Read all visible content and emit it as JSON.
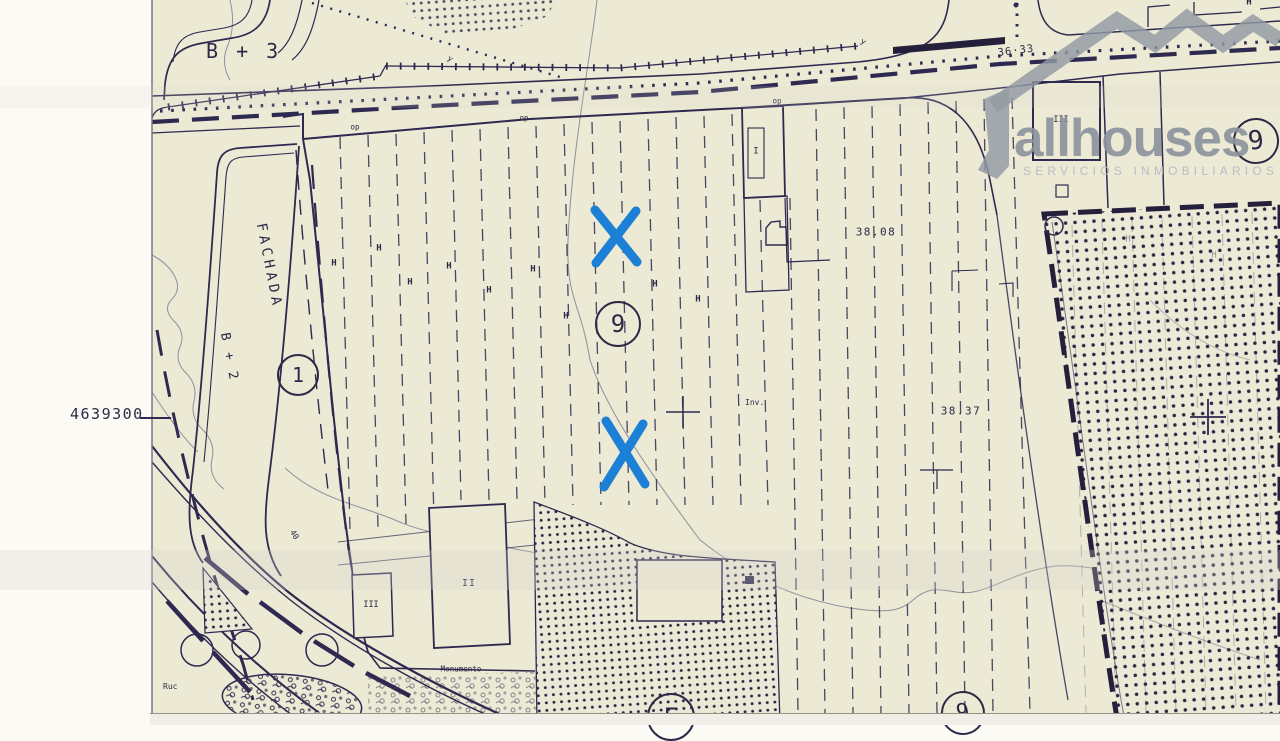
{
  "watermark": {
    "brand": "allhouses",
    "tagline": "SERVICIOS INMOBILIARIOS"
  },
  "map_labels": {
    "coordinate": "4639300",
    "block_top": "B + 3",
    "fachada": "FACHADA",
    "block_left": "B + 2",
    "circle_1": "1",
    "circle_9": "9",
    "circle_e": "E",
    "h_mark": "H",
    "op_mark": "op",
    "y_mark": "y",
    "inv": "Inv.",
    "elev_38_08": "38.08",
    "elev_38_37": "38.37",
    "elev_36_33": "36·33",
    "monumento": "Monumento",
    "ruc": "Ruc",
    "roman_1": "I",
    "roman_2": "II",
    "roman_3": "III",
    "slope_40": "40"
  },
  "annotations": {
    "marker_shape": "X",
    "marker_count": 2,
    "marker_color": "#1b80d6"
  },
  "colors": {
    "paper": "#ece9d4",
    "ink": "#2e2950",
    "margin": "#fbfaf4",
    "watermark_gray": "#939aa4",
    "marker_blue": "#1b80d6"
  }
}
